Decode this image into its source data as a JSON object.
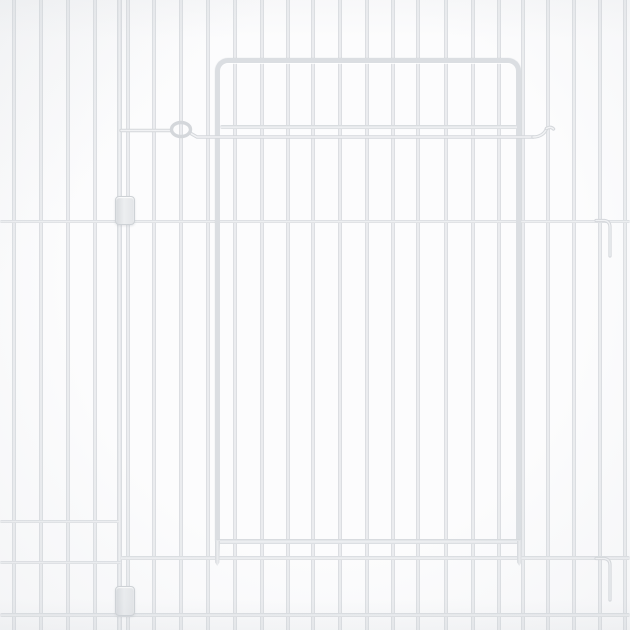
{
  "scene": {
    "description": "Product photo of a white metal wire pet playpen panel with a hinged door, sliding wire latch bar, plastic panel-connector clips and attachment hooks, on a plain white background",
    "background_color": "#fcfcfd",
    "wire_color": "#e7e9ec",
    "wire_edge_color": "#d4d7db",
    "wire_highlight_color": "#f1f2f4",
    "door_frame_color": "#dbdee2",
    "clip_color": "#e6e8ea",
    "clip_border_color": "#ced2d6"
  },
  "geometry": {
    "canvas": {
      "width": 630,
      "height": 630
    },
    "vertical_wires": [
      14,
      41,
      68,
      95,
      154,
      181,
      208,
      235,
      262,
      288,
      313,
      340,
      367,
      393,
      418,
      446,
      473,
      499,
      523,
      548,
      574,
      600,
      625
    ],
    "post_wires": [
      119.5,
      128
    ],
    "wire_width": 4,
    "post_wire_width": 4.5,
    "horizontal_rails": [
      {
        "y": 219.5,
        "x": 0,
        "w": 630,
        "h": 3.6
      },
      {
        "y": 519.5,
        "x": 0,
        "w": 119,
        "h": 3.4
      },
      {
        "y": 560.5,
        "x": 0,
        "w": 121,
        "h": 3.4
      },
      {
        "y": 555.5,
        "x": 121,
        "w": 509,
        "h": 4.0
      },
      {
        "y": 613.0,
        "x": 0,
        "w": 630,
        "h": 4.0
      }
    ],
    "door": {
      "frame_left": 214.5,
      "frame_top": 57.5,
      "frame_width": 307.5,
      "frame_height": 483.5,
      "frame_thickness": 5.5,
      "corner_radius": 13,
      "mid_rail": {
        "y": 124.5,
        "x": 220,
        "w": 297,
        "h": 4
      },
      "bottom_rail": {
        "y": 539,
        "x": 216,
        "w": 304.5,
        "h": 4.5
      },
      "pins": [
        {
          "x": 214.5,
          "y": 541,
          "w": 5.5,
          "h": 25
        },
        {
          "x": 516.5,
          "y": 541,
          "w": 5.5,
          "h": 25
        }
      ]
    },
    "latch": {
      "stroke_width": 3.4,
      "paths": [
        "M 121 130.5 H 170",
        "M 190 133 L 197 137 H 533",
        "M 533 137 C 540 137 545 133.5 546.5 128.5",
        "M 546.5 128.5 q 4.5 -2.5 7 0.5"
      ],
      "loop": {
        "cx": 181,
        "cy": 129.5,
        "rx": 9.5,
        "ry": 7
      }
    },
    "hooks": {
      "stroke_width": 3.2,
      "paths": [
        "M 596 220.5 h 8.5 q 5.5 0.8 5.5 6.5 v 29",
        "M 596 558.5 h 8.5 q 5.5 0.8 5.5 6.5 v 35"
      ]
    },
    "clips": [
      {
        "x": 114.5,
        "y": 196,
        "w": 18.5,
        "h": 27
      },
      {
        "x": 114.5,
        "y": 586,
        "w": 18.5,
        "h": 28
      }
    ]
  }
}
